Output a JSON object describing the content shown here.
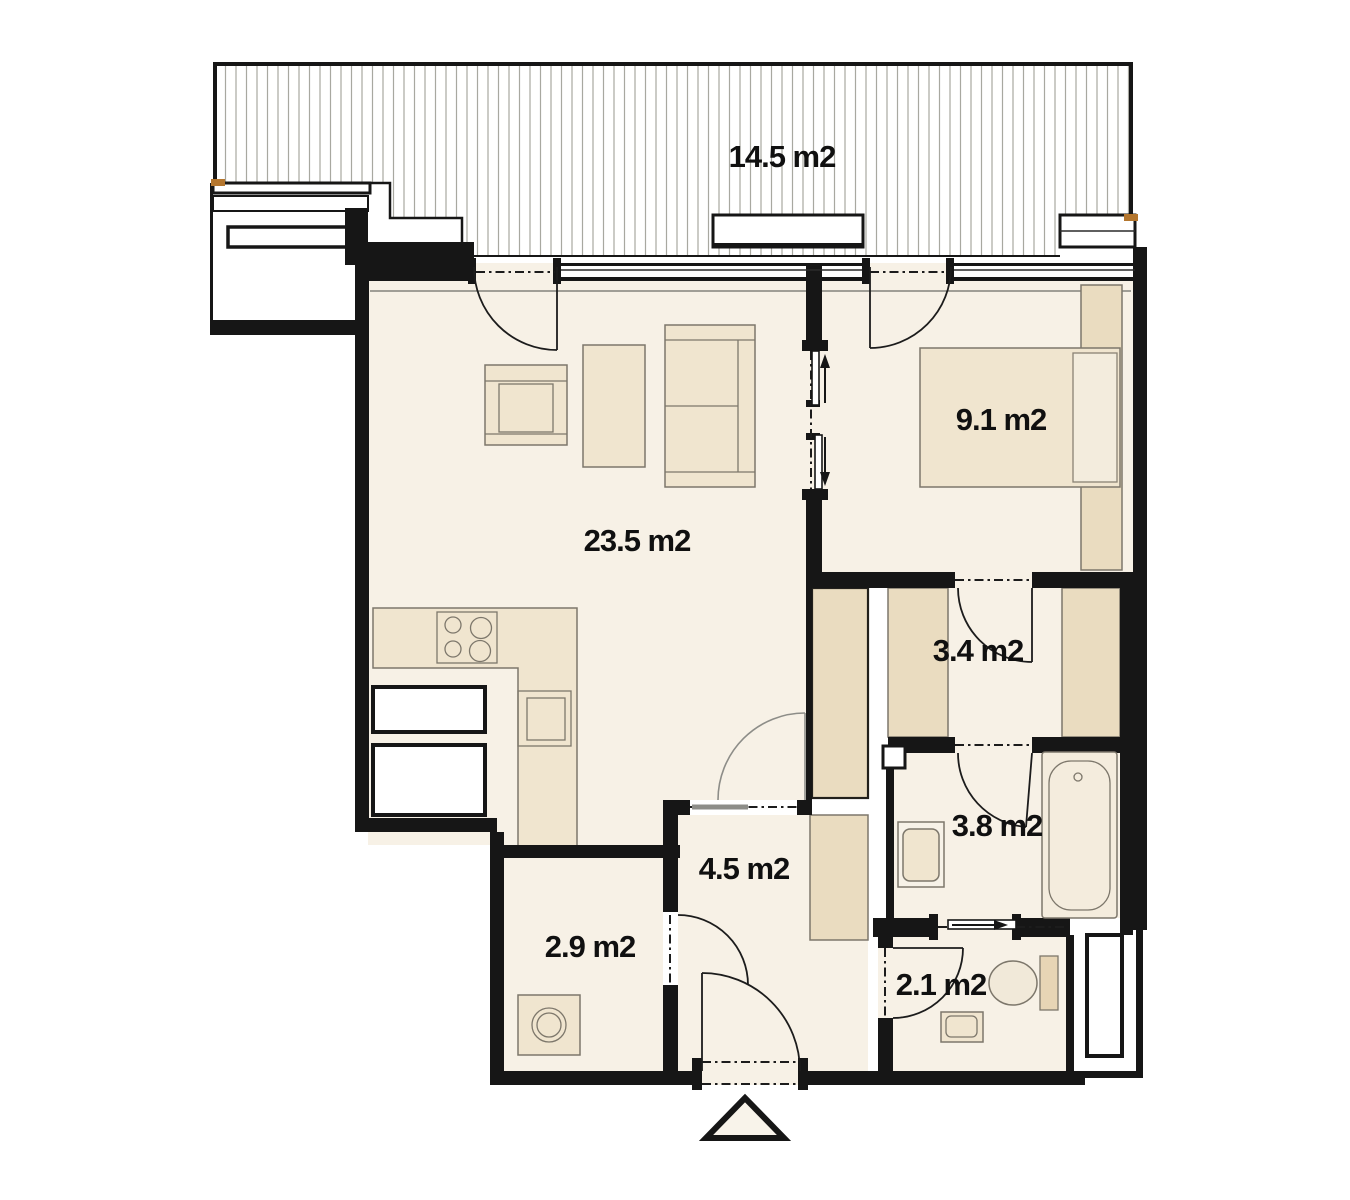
{
  "floor_plan": {
    "rooms": {
      "terrace": {
        "area_label": "14.5 m2"
      },
      "living_room": {
        "area_label": "23.5 m2"
      },
      "bedroom": {
        "area_label": "9.1 m2"
      },
      "closet": {
        "area_label": "3.4 m2"
      },
      "bathroom": {
        "area_label": "3.8 m2"
      },
      "hall": {
        "area_label": "4.5 m2"
      },
      "utility_room": {
        "area_label": "2.9 m2"
      },
      "wc": {
        "area_label": "2.1 m2"
      }
    },
    "colors": {
      "wall": "#161616",
      "floor": "#f7f1e6",
      "furniture": "#f0e5cf",
      "wardrobe": "#eadcc0",
      "hatch_line": "#a8a8a0",
      "outline_gray": "#7d776b",
      "sill_accent": "#b4762e"
    }
  }
}
